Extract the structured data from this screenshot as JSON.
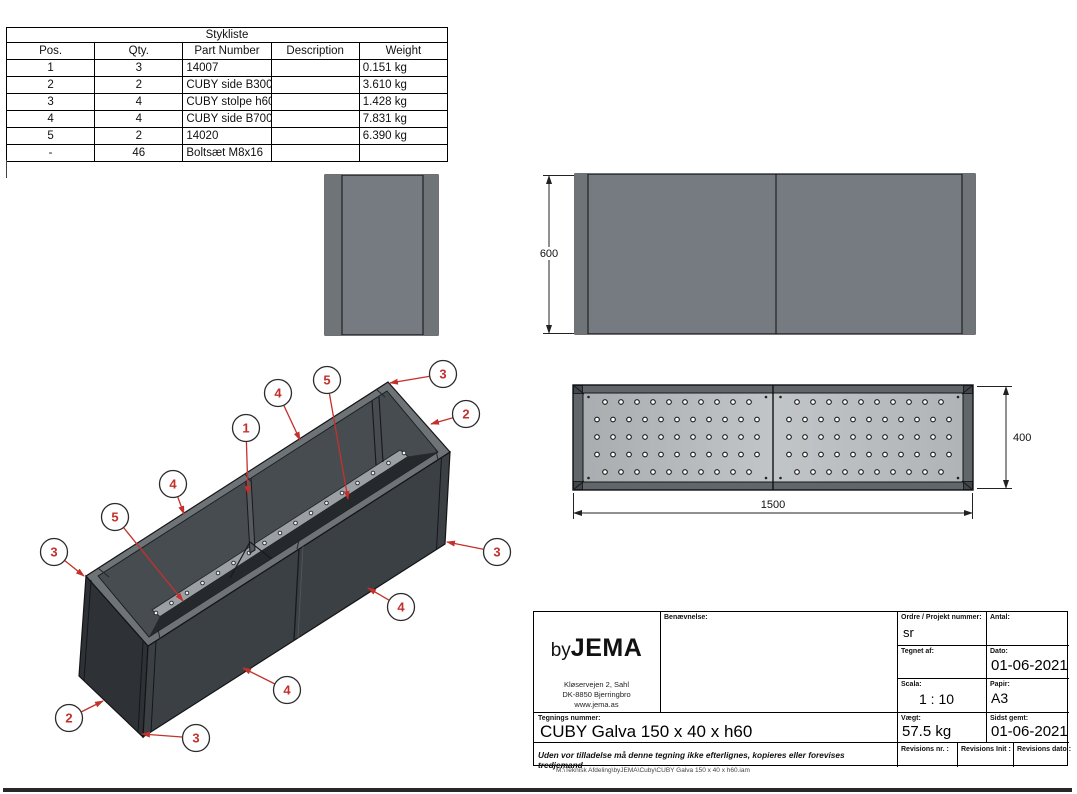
{
  "parts_table": {
    "title": "Stykliste",
    "columns": [
      "Pos.",
      "Qty.",
      "Part Number",
      "Description",
      "Weight"
    ],
    "rows": [
      {
        "pos": "1",
        "qty": "3",
        "part": "14007",
        "desc": "",
        "weight": "0.151 kg"
      },
      {
        "pos": "2",
        "qty": "2",
        "part": "CUBY side B300 H600 Galva",
        "desc": "",
        "weight": "3.610 kg"
      },
      {
        "pos": "3",
        "qty": "4",
        "part": "CUBY stolpe h600 Galva",
        "desc": "",
        "weight": "1.428 kg"
      },
      {
        "pos": "4",
        "qty": "4",
        "part": "CUBY side B700 H600 Galva",
        "desc": "",
        "weight": "7.831 kg"
      },
      {
        "pos": "5",
        "qty": "2",
        "part": "14020",
        "desc": "",
        "weight": "6.390 kg"
      },
      {
        "pos": "-",
        "qty": "46",
        "part": "Boltsæt M8x16",
        "desc": "",
        "weight": ""
      }
    ]
  },
  "dimensions": {
    "height": "600",
    "length": "1500",
    "width": "400"
  },
  "balloons": [
    {
      "label": "3",
      "cx": 443,
      "cy": 374,
      "tx": 390,
      "ty": 383
    },
    {
      "label": "5",
      "cx": 327,
      "cy": 380,
      "tx": 348,
      "ty": 499
    },
    {
      "label": "4",
      "cx": 278,
      "cy": 393,
      "tx": 300,
      "ty": 440
    },
    {
      "label": "2",
      "cx": 466,
      "cy": 414,
      "tx": 431,
      "ty": 424
    },
    {
      "label": "1",
      "cx": 246,
      "cy": 428,
      "tx": 248,
      "ty": 494
    },
    {
      "label": "4",
      "cx": 173,
      "cy": 484,
      "tx": 184,
      "ty": 514
    },
    {
      "label": "5",
      "cx": 115,
      "cy": 517,
      "tx": 183,
      "ty": 601
    },
    {
      "label": "3",
      "cx": 54,
      "cy": 552,
      "tx": 84,
      "ty": 576
    },
    {
      "label": "3",
      "cx": 497,
      "cy": 552,
      "tx": 447,
      "ty": 542
    },
    {
      "label": "4",
      "cx": 401,
      "cy": 607,
      "tx": 368,
      "ty": 588
    },
    {
      "label": "4",
      "cx": 287,
      "cy": 690,
      "tx": 243,
      "ty": 668
    },
    {
      "label": "2",
      "cx": 69,
      "cy": 718,
      "tx": 103,
      "ty": 701
    },
    {
      "label": "3",
      "cx": 196,
      "cy": 738,
      "tx": 142,
      "ty": 734
    }
  ],
  "title_block": {
    "logo_by": "by",
    "logo_name": "JEMA",
    "address": [
      "Kløservejen 2, Sahl",
      "DK-8850 Bjerringbro",
      "www.jema.as"
    ],
    "labels": {
      "benaevnelse": "Benævnelse:",
      "ordre": "Ordre / Projekt nummer:",
      "antal": "Antal:",
      "tegnet_af": "Tegnet af:",
      "dato": "Dato:",
      "scala": "Scala:",
      "papir": "Papir:",
      "tegnings_nummer": "Tegnings nummer:",
      "vaegt": "Vægt:",
      "sidst_gemt": "Sidst gemt:",
      "rev_nr": "Revisions nr. :",
      "rev_init": "Revisions Init :",
      "rev_dato": "Revisions dato :"
    },
    "values": {
      "tegnet_af": "sr",
      "dato": "01-06-2021",
      "scala": "1 : 10",
      "papir": "A3",
      "tegnings_nummer": "CUBY Galva 150 x 40 x h60",
      "vaegt": "57.5 kg",
      "sidst_gemt": "01-06-2021"
    },
    "disclaimer": "Uden vor tilladelse må denne tegning ikke efterlignes, kopieres eller forevises tredjemand"
  },
  "footer_path": "M:\\Teknisk Afdeling\\byJEMA\\Cuby\\CUBY Galva 150 x 40 x h60.iam",
  "colors": {
    "callout_red": "#c3312c",
    "panel_gray": "#757b80",
    "panel_gray_dark": "#6b7175",
    "iso_front": "#3b4044",
    "iso_end": "#2e3236",
    "iso_rim": "#6d7377",
    "plate_light": "#b9bcbe",
    "line_black": "#111111"
  }
}
